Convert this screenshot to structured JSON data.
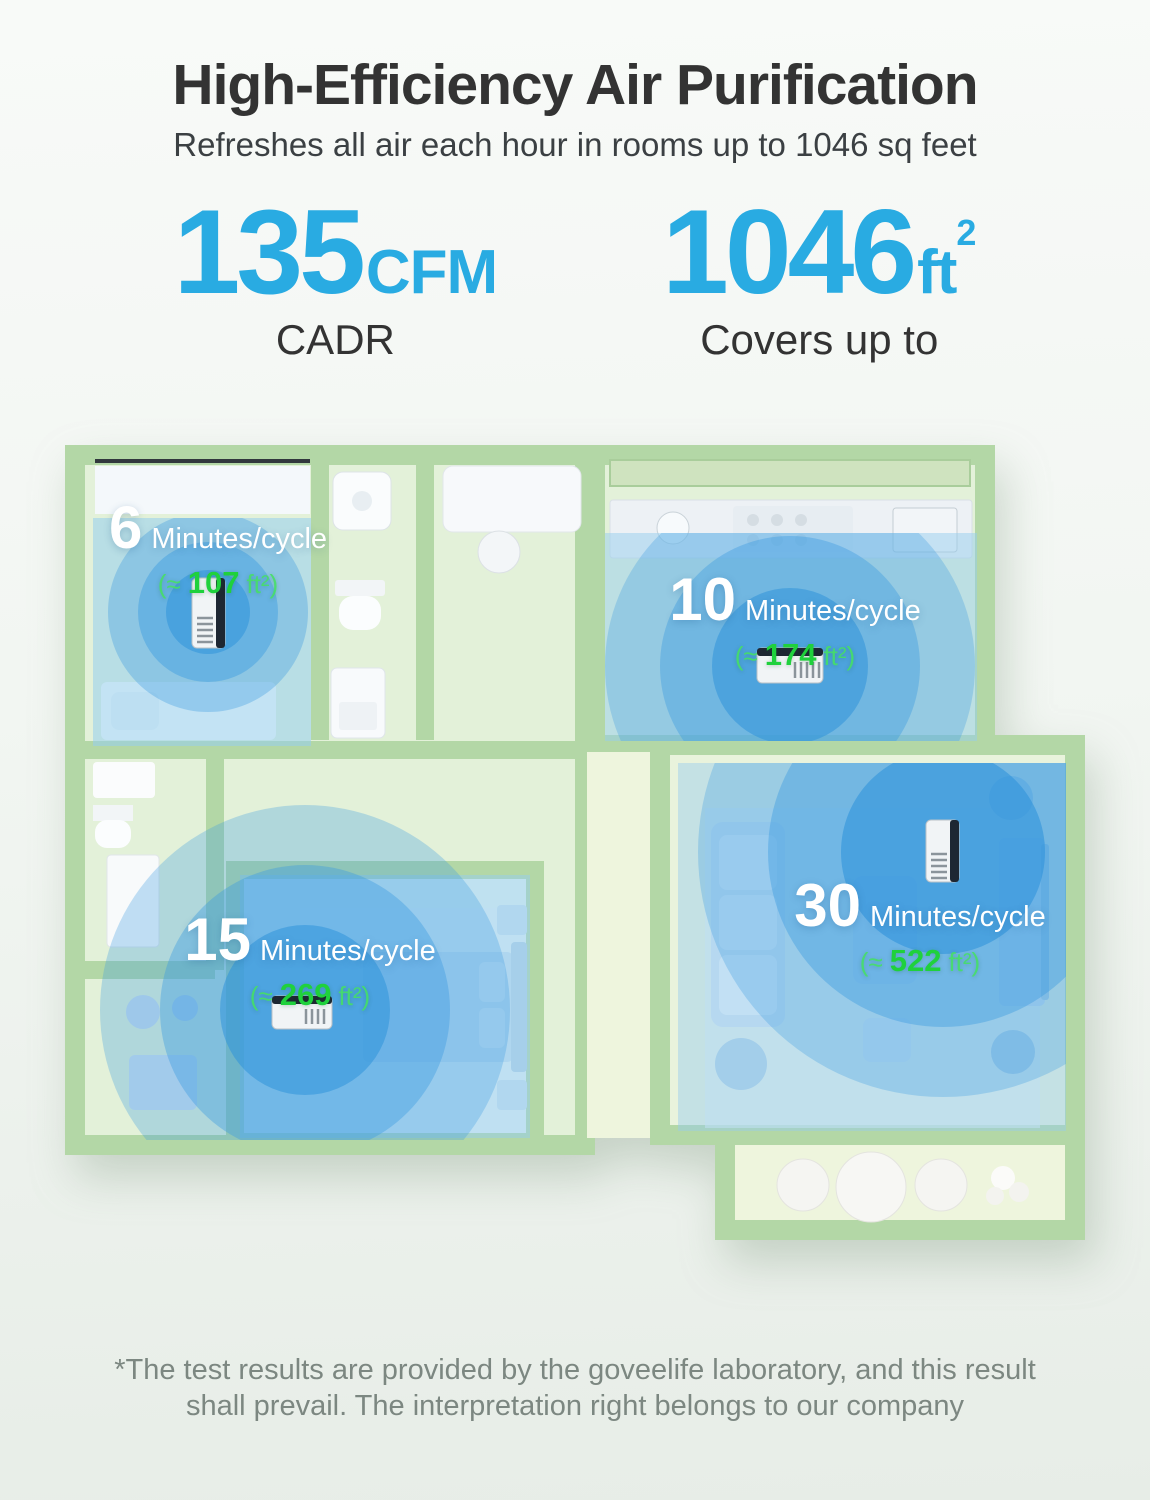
{
  "header": {
    "title": "High-Efficiency Air Purification",
    "subtitle": "Refreshes all air each hour in rooms up to 1046 sq feet"
  },
  "stats": [
    {
      "value": "135",
      "unit": "CFM",
      "sup": "",
      "label": "CADR"
    },
    {
      "value": "1046",
      "unit": "ft",
      "sup": "2",
      "label": "Covers up to"
    }
  ],
  "rooms": [
    {
      "minutes": "6",
      "cycle_label": "Minutes/cycle",
      "area_prefix": "(≈",
      "area_value": "107",
      "area_suffix": "ft²)"
    },
    {
      "minutes": "10",
      "cycle_label": "Minutes/cycle",
      "area_prefix": "(≈",
      "area_value": "174",
      "area_suffix": "ft²)"
    },
    {
      "minutes": "15",
      "cycle_label": "Minutes/cycle",
      "area_prefix": "(≈",
      "area_value": "269",
      "area_suffix": "ft²)"
    },
    {
      "minutes": "30",
      "cycle_label": "Minutes/cycle",
      "area_prefix": "(≈",
      "area_value": "522",
      "area_suffix": "ft²)"
    }
  ],
  "footnote": {
    "lines": [
      "*The test results are provided by the goveelife laboratory, and this result",
      "shall prevail. The interpretation right belongs to our company"
    ]
  },
  "colors": {
    "accent_blue": "#29abe2",
    "highlight_green": "#1fd13c",
    "wall_green": "#b3d7a6",
    "floor_green": "#e3f1d9",
    "coverage_blue": "#3c9ce0",
    "title_text": "#333333",
    "footnote_text": "#7c8781"
  }
}
